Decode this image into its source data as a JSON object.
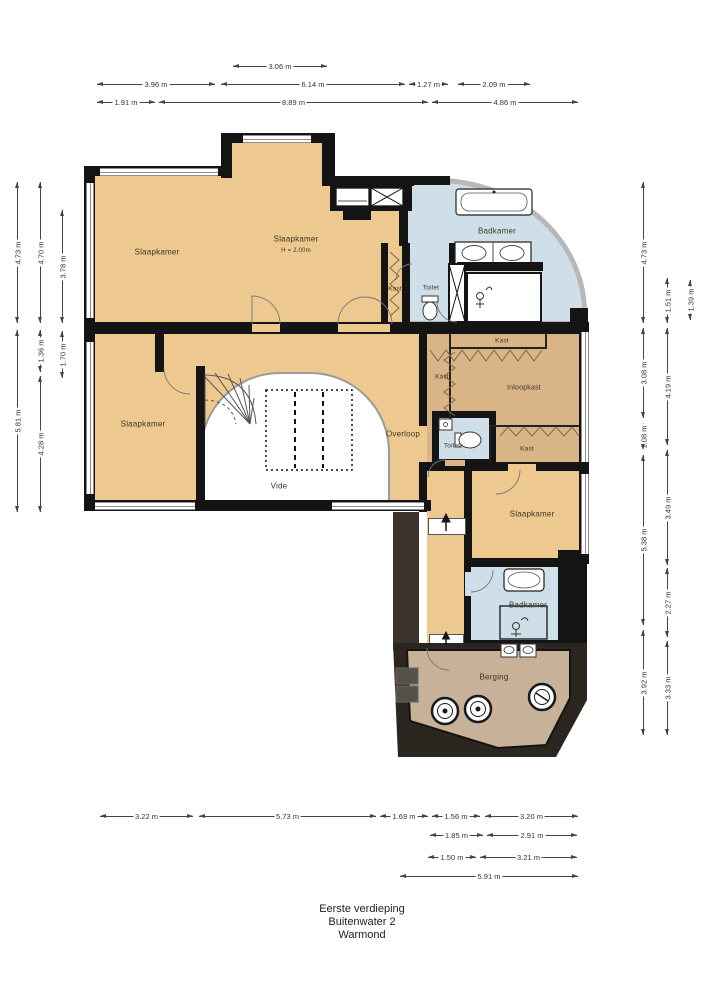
{
  "title": {
    "lines": [
      "Eerste verdieping",
      "Buitenwater 2",
      "Warmond"
    ]
  },
  "colors": {
    "room_fill": "#eec98f",
    "closet_fill": "#d9b487",
    "bath_fill": "#cfdfe9",
    "storage_fill": "#c7b299",
    "wall": "#141414",
    "roof_dark": "#2b261f",
    "glass": "#b8b8b8",
    "dimension": "#444444"
  },
  "room_labels": [
    {
      "name": "slaapkamer-1",
      "text": "Slaapkamer",
      "x": 157,
      "y": 252,
      "size": 8
    },
    {
      "name": "slaapkamer-2",
      "text": "Slaapkamer",
      "x": 296,
      "y": 239,
      "size": 8
    },
    {
      "name": "slaapkamer-2-height",
      "text": "H = 2.00m",
      "x": 296,
      "y": 251,
      "size": 6
    },
    {
      "name": "badkamer-1",
      "text": "Badkamer",
      "x": 497,
      "y": 231,
      "size": 8
    },
    {
      "name": "toilet-1",
      "text": "Toilet",
      "x": 431,
      "y": 288,
      "size": 6.5
    },
    {
      "name": "kast-1",
      "text": "Kast",
      "x": 395,
      "y": 289,
      "size": 6.5
    },
    {
      "name": "kast-2",
      "text": "Kast",
      "x": 502,
      "y": 341,
      "size": 6.5
    },
    {
      "name": "kast-3",
      "text": "Kast",
      "x": 442,
      "y": 377,
      "size": 6.5
    },
    {
      "name": "inloopkast",
      "text": "Inloopkast",
      "x": 524,
      "y": 388,
      "size": 7
    },
    {
      "name": "toilet-2",
      "text": "Toilet",
      "x": 452,
      "y": 446,
      "size": 6.5
    },
    {
      "name": "kast-4",
      "text": "Kast",
      "x": 527,
      "y": 449,
      "size": 6.5
    },
    {
      "name": "overloop",
      "text": "Overloop",
      "x": 403,
      "y": 434,
      "size": 8
    },
    {
      "name": "slaapkamer-3",
      "text": "Slaapkamer",
      "x": 143,
      "y": 424,
      "size": 8
    },
    {
      "name": "vide",
      "text": "Vide",
      "x": 279,
      "y": 486,
      "size": 8
    },
    {
      "name": "slaapkamer-4",
      "text": "Slaapkamer",
      "x": 532,
      "y": 514,
      "size": 8
    },
    {
      "name": "badkamer-2",
      "text": "Badkamer",
      "x": 528,
      "y": 605,
      "size": 8
    },
    {
      "name": "berging",
      "text": "Berging",
      "x": 494,
      "y": 677,
      "size": 8
    }
  ],
  "dimensions": [
    {
      "group": "top",
      "label": "3.06 m",
      "orient": "h",
      "x": 233,
      "y": 66,
      "len": 94
    },
    {
      "group": "top",
      "label": "3.96 m",
      "orient": "h",
      "x": 97,
      "y": 84,
      "len": 118
    },
    {
      "group": "top",
      "label": "6.14 m",
      "orient": "h",
      "x": 221,
      "y": 84,
      "len": 184
    },
    {
      "group": "top",
      "label": "1.27 m",
      "orient": "h",
      "x": 409,
      "y": 84,
      "len": 39
    },
    {
      "group": "top",
      "label": "2.09 m",
      "orient": "h",
      "x": 458,
      "y": 84,
      "len": 72
    },
    {
      "group": "top",
      "label": "1.91 m",
      "orient": "h",
      "x": 97,
      "y": 102,
      "len": 58
    },
    {
      "group": "top",
      "label": "8.89 m",
      "orient": "h",
      "x": 159,
      "y": 102,
      "len": 269
    },
    {
      "group": "top",
      "label": "4.86 m",
      "orient": "h",
      "x": 432,
      "y": 102,
      "len": 146
    },
    {
      "group": "left",
      "label": "4.73 m",
      "orient": "v",
      "x": 17,
      "y": 182,
      "len": 141
    },
    {
      "group": "left",
      "label": "4.70 m",
      "orient": "v",
      "x": 40,
      "y": 182,
      "len": 141
    },
    {
      "group": "left",
      "label": "3.78 m",
      "orient": "v",
      "x": 62,
      "y": 210,
      "len": 113
    },
    {
      "group": "left",
      "label": "1.36 m",
      "orient": "v",
      "x": 40,
      "y": 330,
      "len": 42
    },
    {
      "group": "left",
      "label": "1.70 m",
      "orient": "v",
      "x": 62,
      "y": 331,
      "len": 47
    },
    {
      "group": "left",
      "label": "5.81 m",
      "orient": "v",
      "x": 17,
      "y": 330,
      "len": 182
    },
    {
      "group": "left",
      "label": "4.28 m",
      "orient": "v",
      "x": 40,
      "y": 376,
      "len": 136
    },
    {
      "group": "right",
      "label": "4.73 m",
      "orient": "v",
      "x": 643,
      "y": 182,
      "len": 141
    },
    {
      "group": "right",
      "label": "1.51 m",
      "orient": "v",
      "x": 667,
      "y": 278,
      "len": 45
    },
    {
      "group": "right",
      "label": "1.39 m",
      "orient": "v",
      "x": 690,
      "y": 280,
      "len": 40
    },
    {
      "group": "right",
      "label": "3.08 m",
      "orient": "v",
      "x": 643,
      "y": 328,
      "len": 90
    },
    {
      "group": "right",
      "label": "4.19 m",
      "orient": "v",
      "x": 667,
      "y": 328,
      "len": 117
    },
    {
      "group": "right",
      "label": "1.08 m",
      "orient": "v",
      "x": 643,
      "y": 423,
      "len": 27
    },
    {
      "group": "right",
      "label": "5.38 m",
      "orient": "v",
      "x": 643,
      "y": 455,
      "len": 170
    },
    {
      "group": "right",
      "label": "3.49 m",
      "orient": "v",
      "x": 667,
      "y": 450,
      "len": 115
    },
    {
      "group": "right",
      "label": "2.27 m",
      "orient": "v",
      "x": 667,
      "y": 568,
      "len": 69
    },
    {
      "group": "right",
      "label": "3.92 m",
      "orient": "v",
      "x": 643,
      "y": 630,
      "len": 105
    },
    {
      "group": "right",
      "label": "3.33 m",
      "orient": "v",
      "x": 667,
      "y": 641,
      "len": 94
    },
    {
      "group": "bottom",
      "label": "3.22 m",
      "orient": "h",
      "x": 100,
      "y": 816,
      "len": 93
    },
    {
      "group": "bottom",
      "label": "5.73 m",
      "orient": "h",
      "x": 199,
      "y": 816,
      "len": 177
    },
    {
      "group": "bottom",
      "label": "1.69 m",
      "orient": "h",
      "x": 380,
      "y": 816,
      "len": 48
    },
    {
      "group": "bottom",
      "label": "1.56 m",
      "orient": "h",
      "x": 432,
      "y": 816,
      "len": 48
    },
    {
      "group": "bottom",
      "label": "3.20 m",
      "orient": "h",
      "x": 485,
      "y": 816,
      "len": 93
    },
    {
      "group": "bottom",
      "label": "1.85 m",
      "orient": "h",
      "x": 430,
      "y": 835,
      "len": 53
    },
    {
      "group": "bottom",
      "label": "2.91 m",
      "orient": "h",
      "x": 487,
      "y": 835,
      "len": 90
    },
    {
      "group": "bottom",
      "label": "1.50 m",
      "orient": "h",
      "x": 428,
      "y": 857,
      "len": 48
    },
    {
      "group": "bottom",
      "label": "3.21 m",
      "orient": "h",
      "x": 480,
      "y": 857,
      "len": 97
    },
    {
      "group": "bottom",
      "label": "5.91 m",
      "orient": "h",
      "x": 400,
      "y": 876,
      "len": 178
    }
  ]
}
